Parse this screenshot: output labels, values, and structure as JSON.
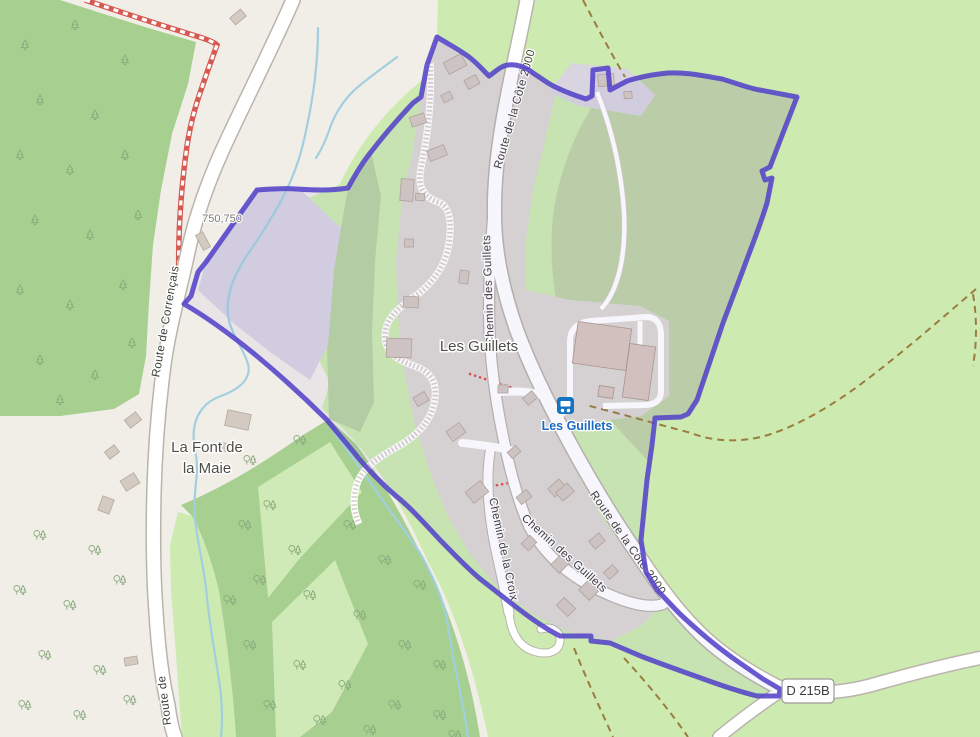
{
  "road_labels": [
    {
      "text": "Route de la Côte 2000"
    },
    {
      "text": "Route de la Côte 2000"
    },
    {
      "text": "Chemin des Guillets"
    },
    {
      "text": "Chemin des Guillets"
    },
    {
      "text": "Chemin de la Croix"
    },
    {
      "text": "Route de Corrençais"
    },
    {
      "text": "Route de"
    }
  ],
  "place_labels": {
    "hamlet": "Les Guillets",
    "farm_line1": "La Font de",
    "farm_line2": "la Maie",
    "parcel_number": "750,750"
  },
  "bus_stop": {
    "label": "Les Guillets",
    "icon": "bus-icon"
  },
  "road_badge": {
    "ref": "D 215B"
  },
  "icons": {
    "bus_stop": "bus-icon",
    "conifer_tree": "conifer-tree-icon",
    "mixed_trees": "mixed-trees-icon"
  },
  "colors": {
    "background": "#f1eee8",
    "forest": "#a6cf90",
    "grass": "#cdebb0",
    "enclosed_field": "#bfd4a7",
    "residential": "#dcd8d3",
    "highlight_parcel": "#d7d3e1",
    "boundary": "#5443c8",
    "stream": "#a2cfe0",
    "track_dash": "#9b7c40",
    "trail_red": "#d65a52",
    "bus_blue": "#1673c2",
    "road_fill": "#ffffff",
    "road_casing": "#b9b4ac"
  }
}
